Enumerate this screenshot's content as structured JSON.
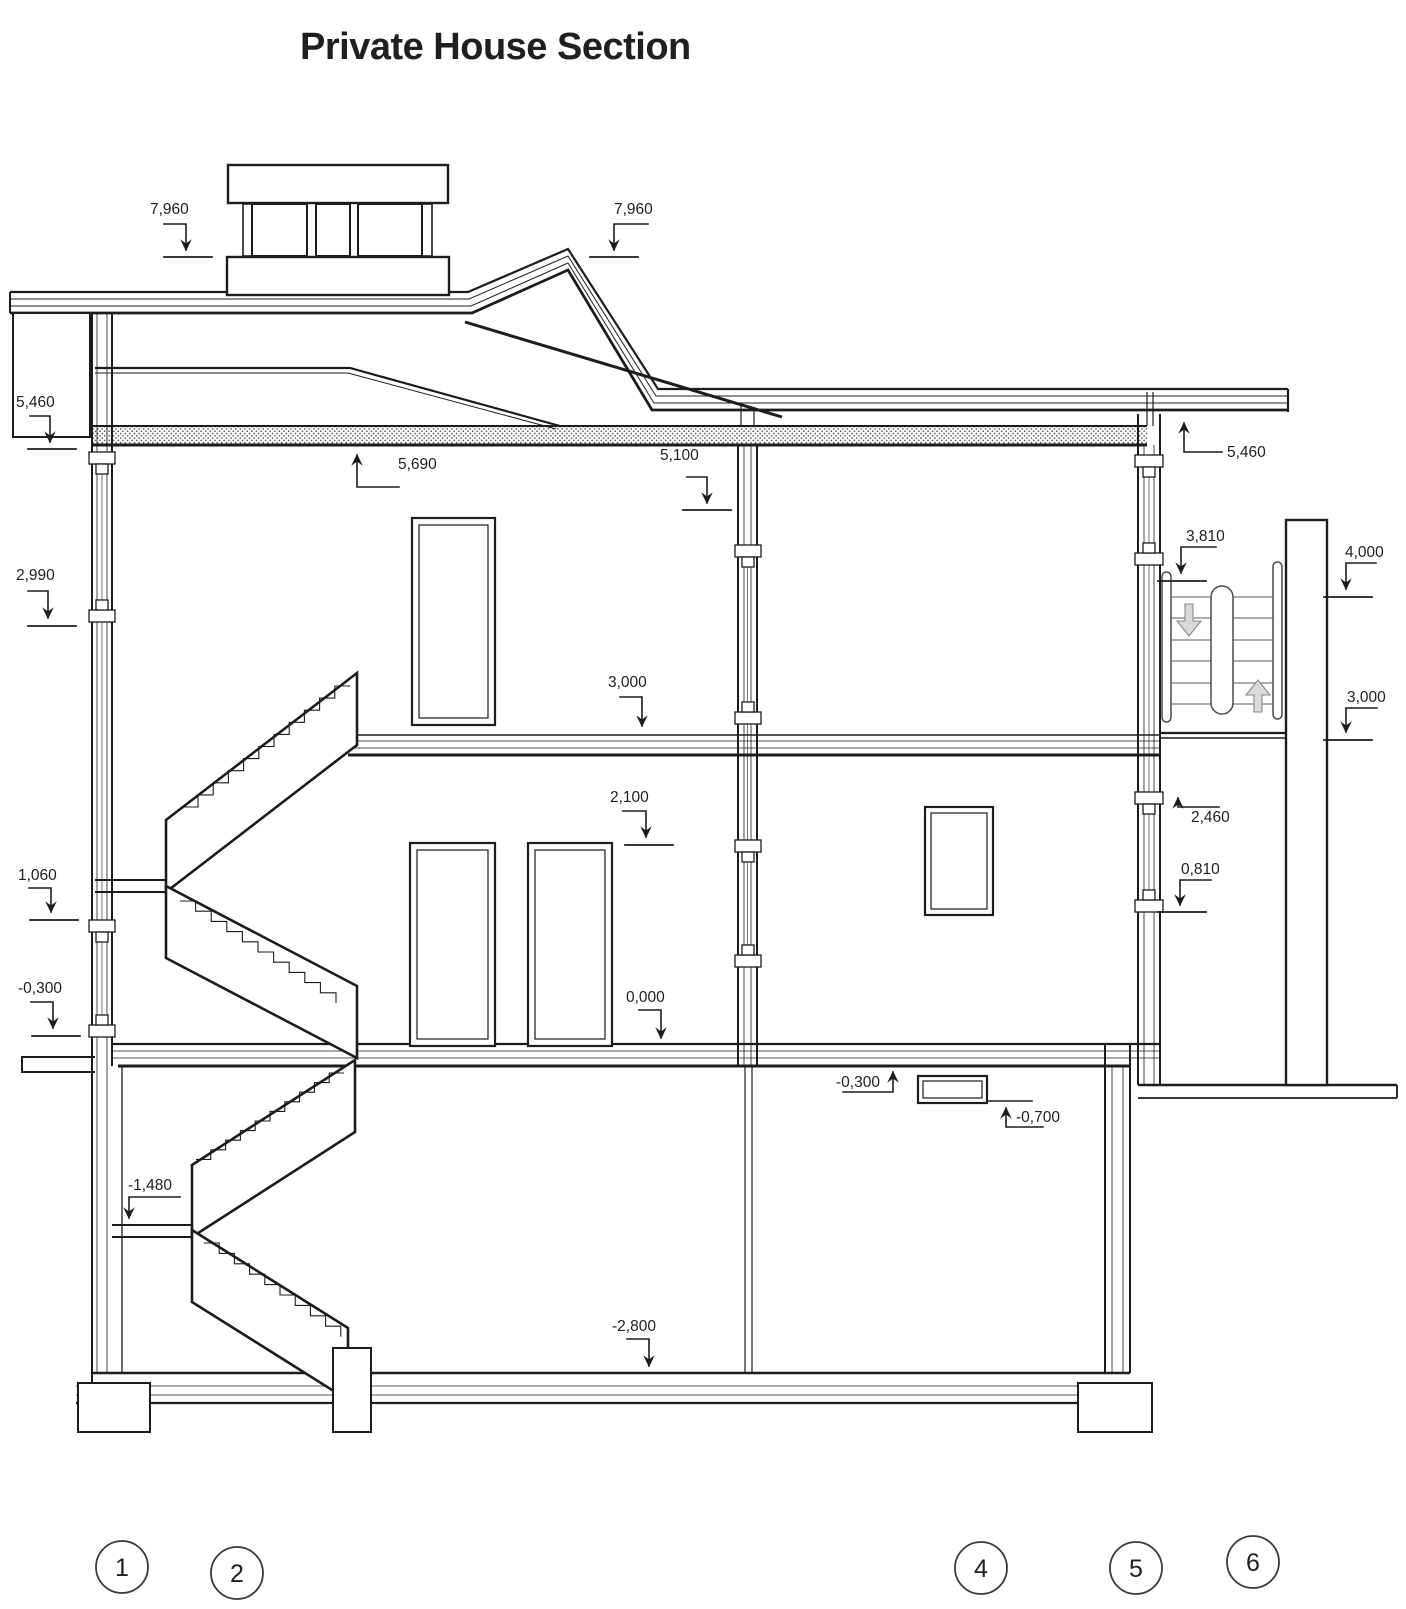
{
  "title": "Private House Section",
  "elevations": {
    "chimney_left": "7,960",
    "chimney_right": "7,960",
    "attic_left": "5,460",
    "ceiling_left": "5,690",
    "ceiling_door": "5,100",
    "attic_right": "5,460",
    "wall_left": "2,990",
    "entry_landing": "3,810",
    "entry_top": "4,000",
    "floor2_mid": "3,000",
    "entry_floor": "3,000",
    "window_head": "2,100",
    "entry_mid": "2,460",
    "window_sill_right": "0,810",
    "stair_landing_left": "1,060",
    "porch_left": "-0,300",
    "ground_floor": "0,000",
    "basement_ceiling": "-0,300",
    "basement_window": "-0,700",
    "basement_landing": "-1,480",
    "basement_floor": "-2,800"
  },
  "grid_bubbles": [
    {
      "label": "1"
    },
    {
      "label": "2"
    },
    {
      "label": "4"
    },
    {
      "label": "5"
    },
    {
      "label": "6"
    }
  ]
}
